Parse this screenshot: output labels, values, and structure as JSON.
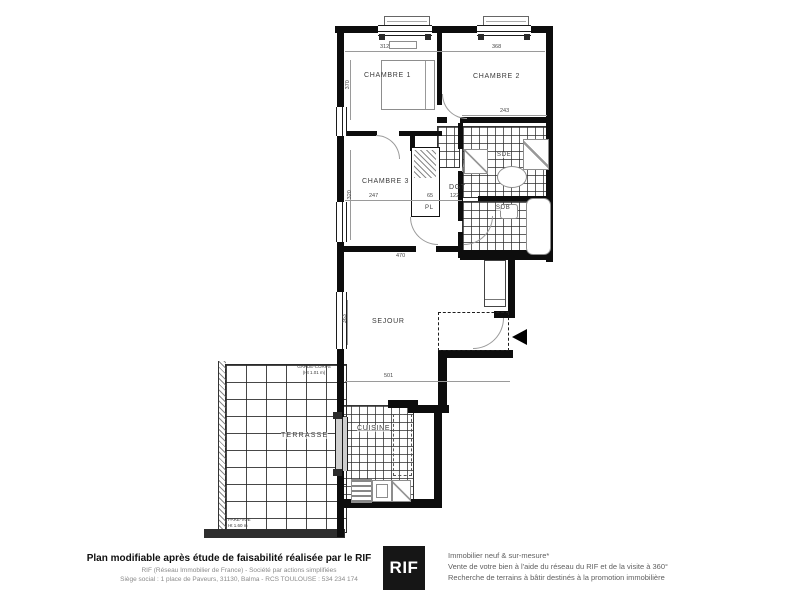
{
  "plan": {
    "rooms": {
      "chambre1": "CHAMBRE 1",
      "chambre2": "CHAMBRE 2",
      "chambre3": "CHAMBRE 3",
      "dgt": "DGT",
      "pl": "PL",
      "sde": "SDE",
      "sdb": "SDB",
      "sejour": "SEJOUR",
      "cuisine": "CUISINE",
      "terrasse": "TERRASSE"
    },
    "annotations": {
      "garde_corps_line1": "GARDE-CORPS",
      "garde_corps_line2": "(Ht 1.01 m)",
      "pare_vue_line1": "PARE-VUE",
      "pare_vue_line2": "Ht 1.60 m"
    },
    "dimensions": {
      "chambre1_width": "312",
      "chambre2_width": "368",
      "chambre2_recess": "243",
      "chambre3_width": "247",
      "pl_width": "65",
      "dgt_width": "122",
      "chambre3_total": "470",
      "sejour_width": "501",
      "chambre1_depth": "370",
      "chambre3_depth": "320",
      "sejour_window": "363"
    }
  },
  "footer": {
    "headline": "Plan modifiable après étude de faisabilité réalisée par le RIF",
    "subline1": "RIF (Réseau Immobilier de France) - Société par actions simplifiées",
    "subline2": "Siège social : 1 place de Paveurs, 31130, Balma - RCS TOULOUSE : 534 234 174",
    "logo_text": "RIF",
    "tagline1": "Immobilier neuf & sur-mesure*",
    "tagline2": "Vente de votre bien à l'aide du réseau du RIF et de la visite à 360°",
    "tagline3": "Recherche de terrains à bâtir destinés à la promotion immobilière"
  }
}
